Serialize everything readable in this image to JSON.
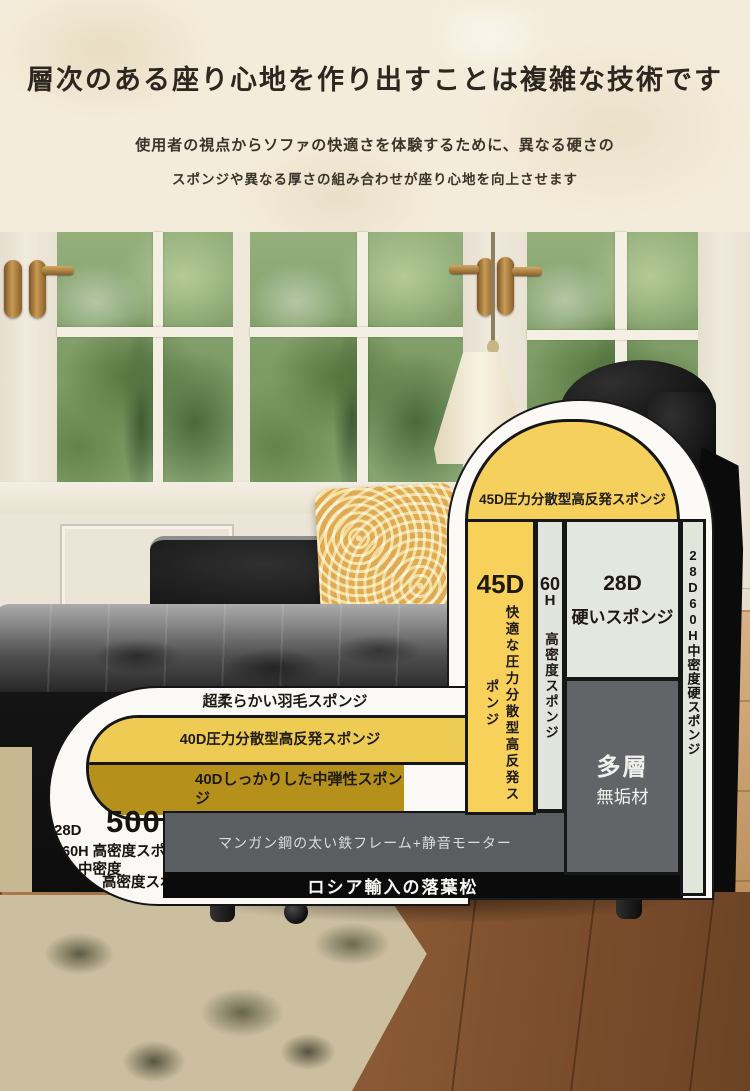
{
  "header": {
    "title": "層次のある座り心地を作り出すことは複雑な技術です",
    "subtitle_line1": "使用者の視点からソファの快適さを体験するために、異なる硬さの",
    "subtitle_line2": "スポンジや異なる厚さの組み合わせが座り心地を向上させます"
  },
  "diagram": {
    "dome_label": "45D圧力分散型高反発スポンジ",
    "columns": {
      "comfort_foam": {
        "grade": "45D",
        "label": "快適な圧力分散型高反発スポンジ"
      },
      "high_density_foam": {
        "grade_num": "60",
        "grade_suffix": "H",
        "label": "高密度スポンジ"
      },
      "firm_foam": {
        "grade": "28D",
        "label": "硬いスポンジ"
      },
      "solid_wood": {
        "title": "多層",
        "label": "無垢材"
      },
      "right_foam": {
        "label": "28D60H中密度硬スポンジ"
      }
    },
    "seat_layers": {
      "feather": "超柔らかい羽毛スポンジ",
      "high_rebound": "40D圧力分散型高反発スポンジ",
      "medium_elastic": "40Dしっかりした中弾性スポンジ"
    },
    "corner_labels": {
      "grade_28d": "28D",
      "number_500": "500",
      "grade_60h": "60H 高密度スポンジ",
      "medium_density": "中密度",
      "high_density": "高密度スポンジ"
    },
    "frame_label": "マンガン鋼の太い鉄フレーム+静音モーター",
    "base_label": "ロシア輸入の落葉松"
  },
  "colors": {
    "banner_bg": "#F4ECDA",
    "foam_yellow": "#F6D05C",
    "foam_olive": "#B5911B",
    "foam_light": "#E2E5DA",
    "wood_box_gray": "#626467",
    "frame_gray": "#5B5E61",
    "base_black": "#0B0B0B",
    "outline_white": "#FBFAF6"
  }
}
